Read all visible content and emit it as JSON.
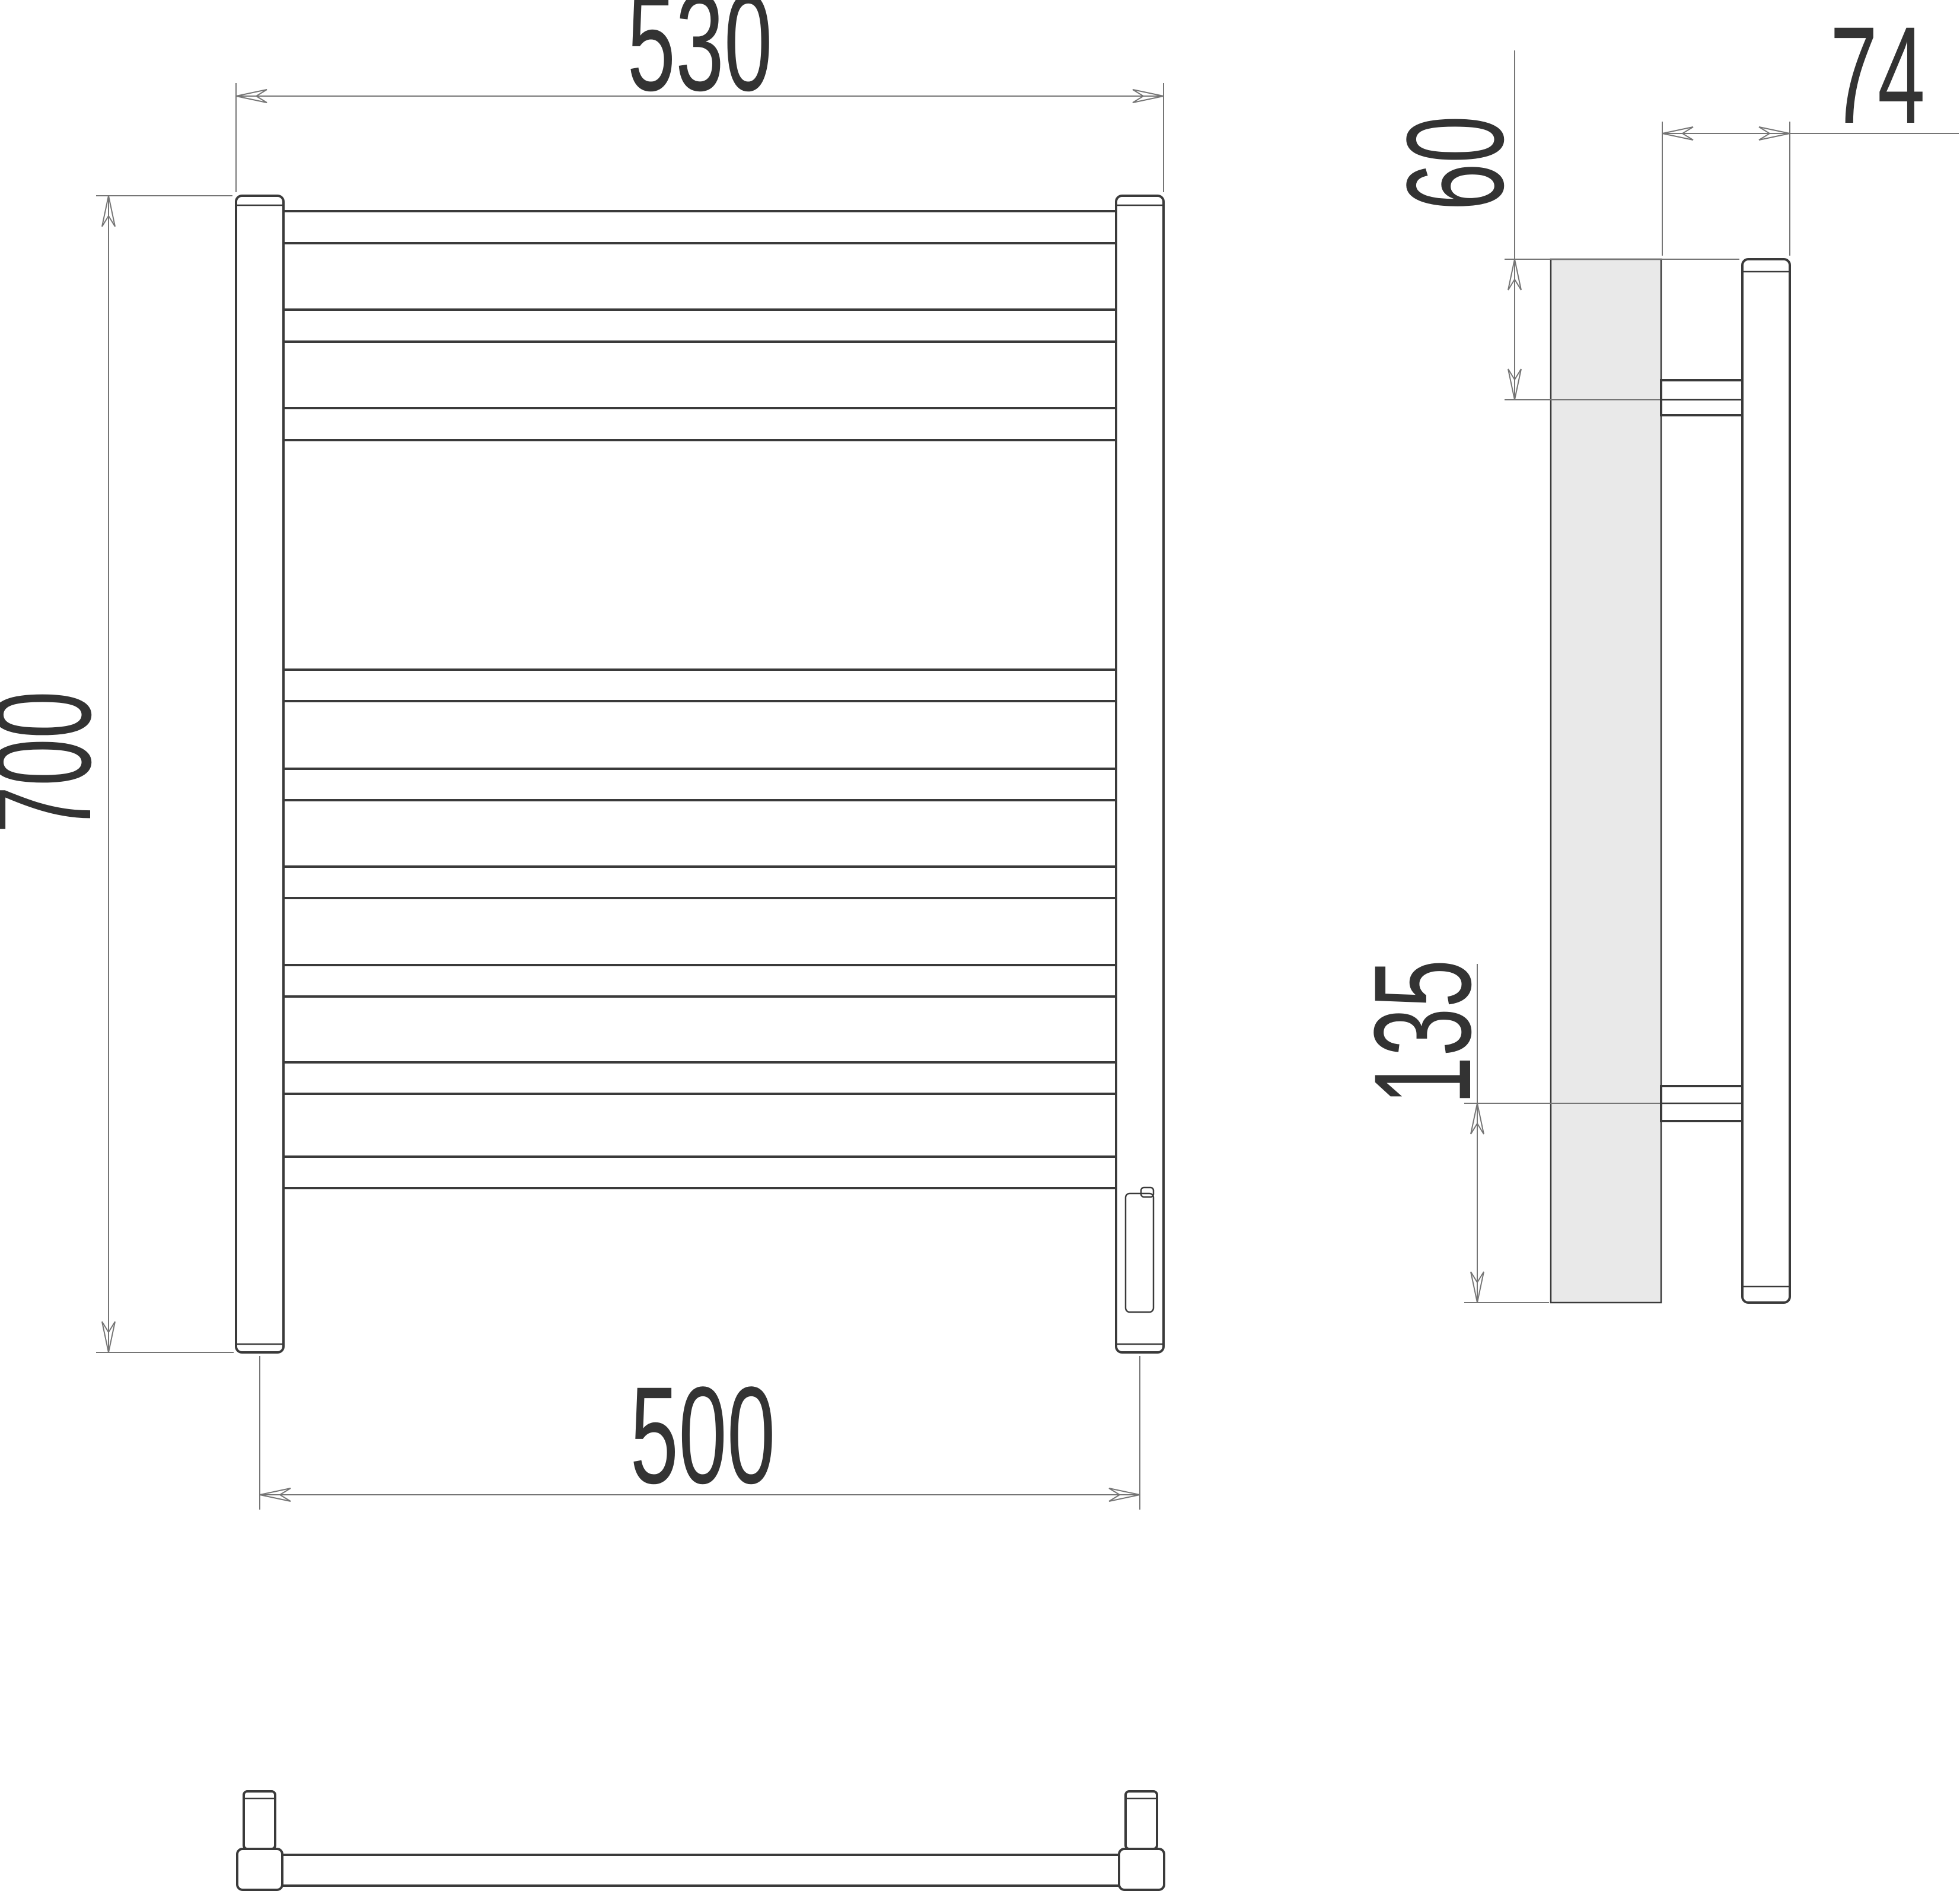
{
  "dimensions": {
    "overall_width": "530",
    "overall_height": "700",
    "mounting_width": "500",
    "depth": "74",
    "top_offset": "60",
    "bottom_offset": "135"
  },
  "colors": {
    "line": "#3a3a3a",
    "dim_line": "#757575",
    "text": "#333333",
    "wall_fill": "#e9e9e9",
    "background": "#ffffff"
  }
}
